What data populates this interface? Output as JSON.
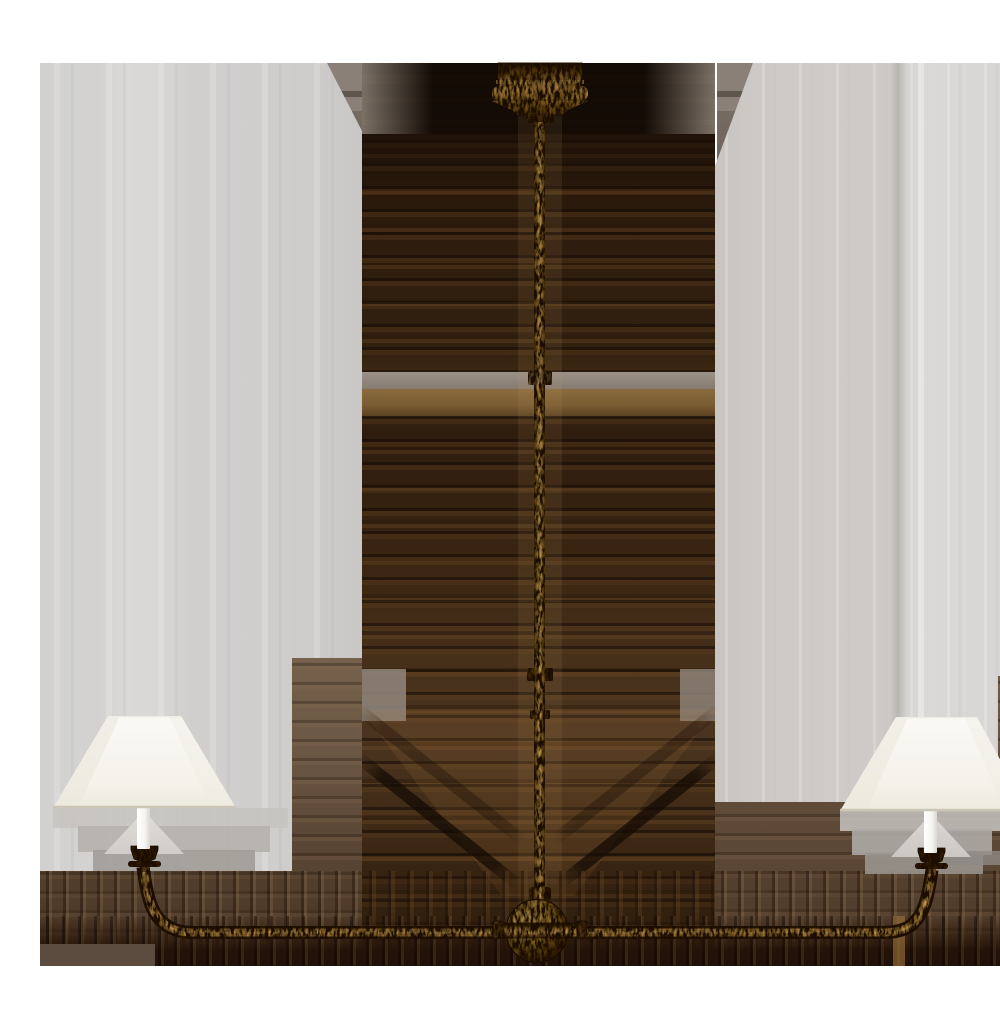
{
  "image": {
    "kind": "product-photo",
    "subject": "Two-light linear chandelier with slender gilded-iron frame, center ball detail, downward curved arms and two cone linen shades, shown on a studio background with compression smear artifacts",
    "visible_text": ""
  },
  "colors": {
    "white_band": "#ffffff",
    "panel_gray": "#d2d1d0",
    "panel_gray_light": "#d8d7d5",
    "taupe_wing": "#8a8078",
    "smear_dark": "#241509",
    "smear_brown": "#5a3a1e",
    "smear_tan": "#8a6b3f",
    "bottom_band": "#241308",
    "gilded_iron": "#96702f",
    "gold_highlight": "#d2a95f",
    "gold_shadow": "#3a2410",
    "linen_shade": "#f4f2ea",
    "candle_white": "#fbfaf6"
  }
}
